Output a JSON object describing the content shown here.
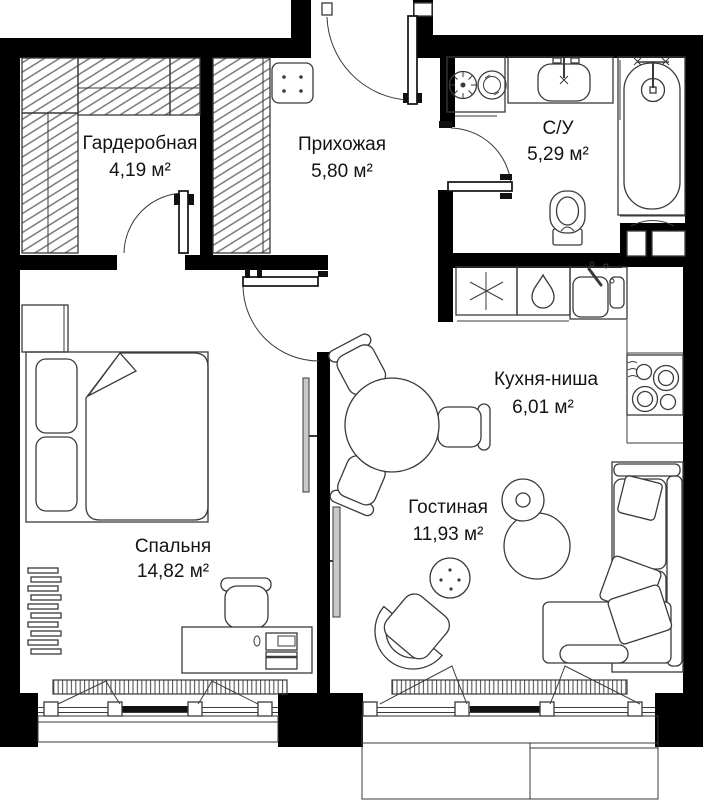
{
  "plan": {
    "type": "apartment-floor-plan",
    "rooms": [
      {
        "id": "wardrobe",
        "name": "Гардеробная",
        "area": "4,19 м²"
      },
      {
        "id": "hallway",
        "name": "Прихожая",
        "area": "5,80 м²"
      },
      {
        "id": "bathroom",
        "name": "С/У",
        "area": "5,29 м²"
      },
      {
        "id": "kitchen",
        "name": "Кухня-ниша",
        "area": "6,01 м²"
      },
      {
        "id": "living",
        "name": "Гостиная",
        "area": "11,93 м²"
      },
      {
        "id": "bedroom",
        "name": "Спальня",
        "area": "14,82 м²"
      }
    ],
    "colors": {
      "wall": "#000000",
      "line": "#3a3a3a",
      "hatch": "#6e6e6e",
      "text": "#141414",
      "bg": "#ffffff"
    },
    "icons": [
      "washing-machine-icon",
      "dryer-icon",
      "bathroom-sink-icon",
      "faucet-icon",
      "bathtub-icon",
      "shower-head-icon",
      "toilet-icon",
      "asterisk-icon",
      "water-drop-icon",
      "kitchen-sink-icon",
      "hob-icon",
      "dining-table-icon",
      "chair-icon",
      "floor-lamp-icon",
      "side-table-icon",
      "armchair-icon",
      "sofa-icon",
      "pillow-icon",
      "tv-icon",
      "bed-icon",
      "pillow-icon",
      "desk-icon",
      "desk-chair-icon",
      "radiator-icon",
      "window-icon",
      "door-leaf-icon",
      "door-swing-icon",
      "shelving-icon",
      "pouf-icon",
      "duct-icon",
      "balcony-icon"
    ]
  }
}
